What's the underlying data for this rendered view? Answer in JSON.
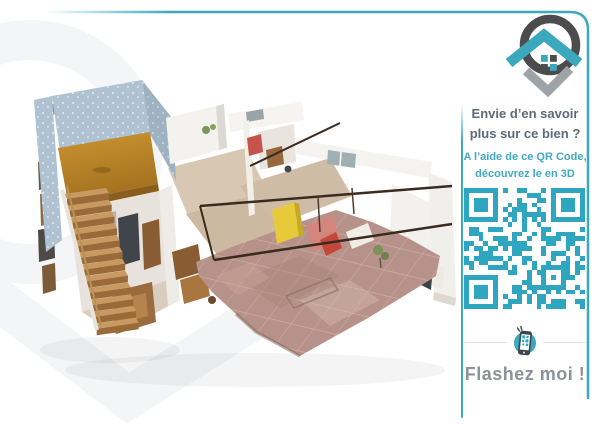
{
  "colors": {
    "accent": "#3aa8bd",
    "qr": "#2ea6bf",
    "heading-text": "#5d6b78",
    "subheading-text": "#41aac1",
    "cta-text": "#8d9298",
    "divider": "#dfe3e6",
    "logo-dark": "#4c4c4e",
    "logo-gray": "#9ea3a7",
    "watermark": "#f4f5f7",
    "background": "#ffffff"
  },
  "brand": {
    "logo_icon": "house-map-pin-logo",
    "watermark_icon": "house-pin-watermark"
  },
  "main_image": {
    "icon": "3d-dollhouse-apartment-scan"
  },
  "panel": {
    "heading": {
      "line1": "Envie d’en savoir",
      "line2": "plus sur ce bien ?"
    },
    "subheading": {
      "line1": "A l’aide de ce QR Code,",
      "line2": "découvrez le en 3D"
    },
    "qr_code": {
      "icon": "qr-code",
      "modules": 25,
      "seed": 987654321
    },
    "scan_hint": {
      "icon": "smartphone-scan-icon"
    },
    "cta": {
      "label": "Flashez moi !"
    }
  }
}
